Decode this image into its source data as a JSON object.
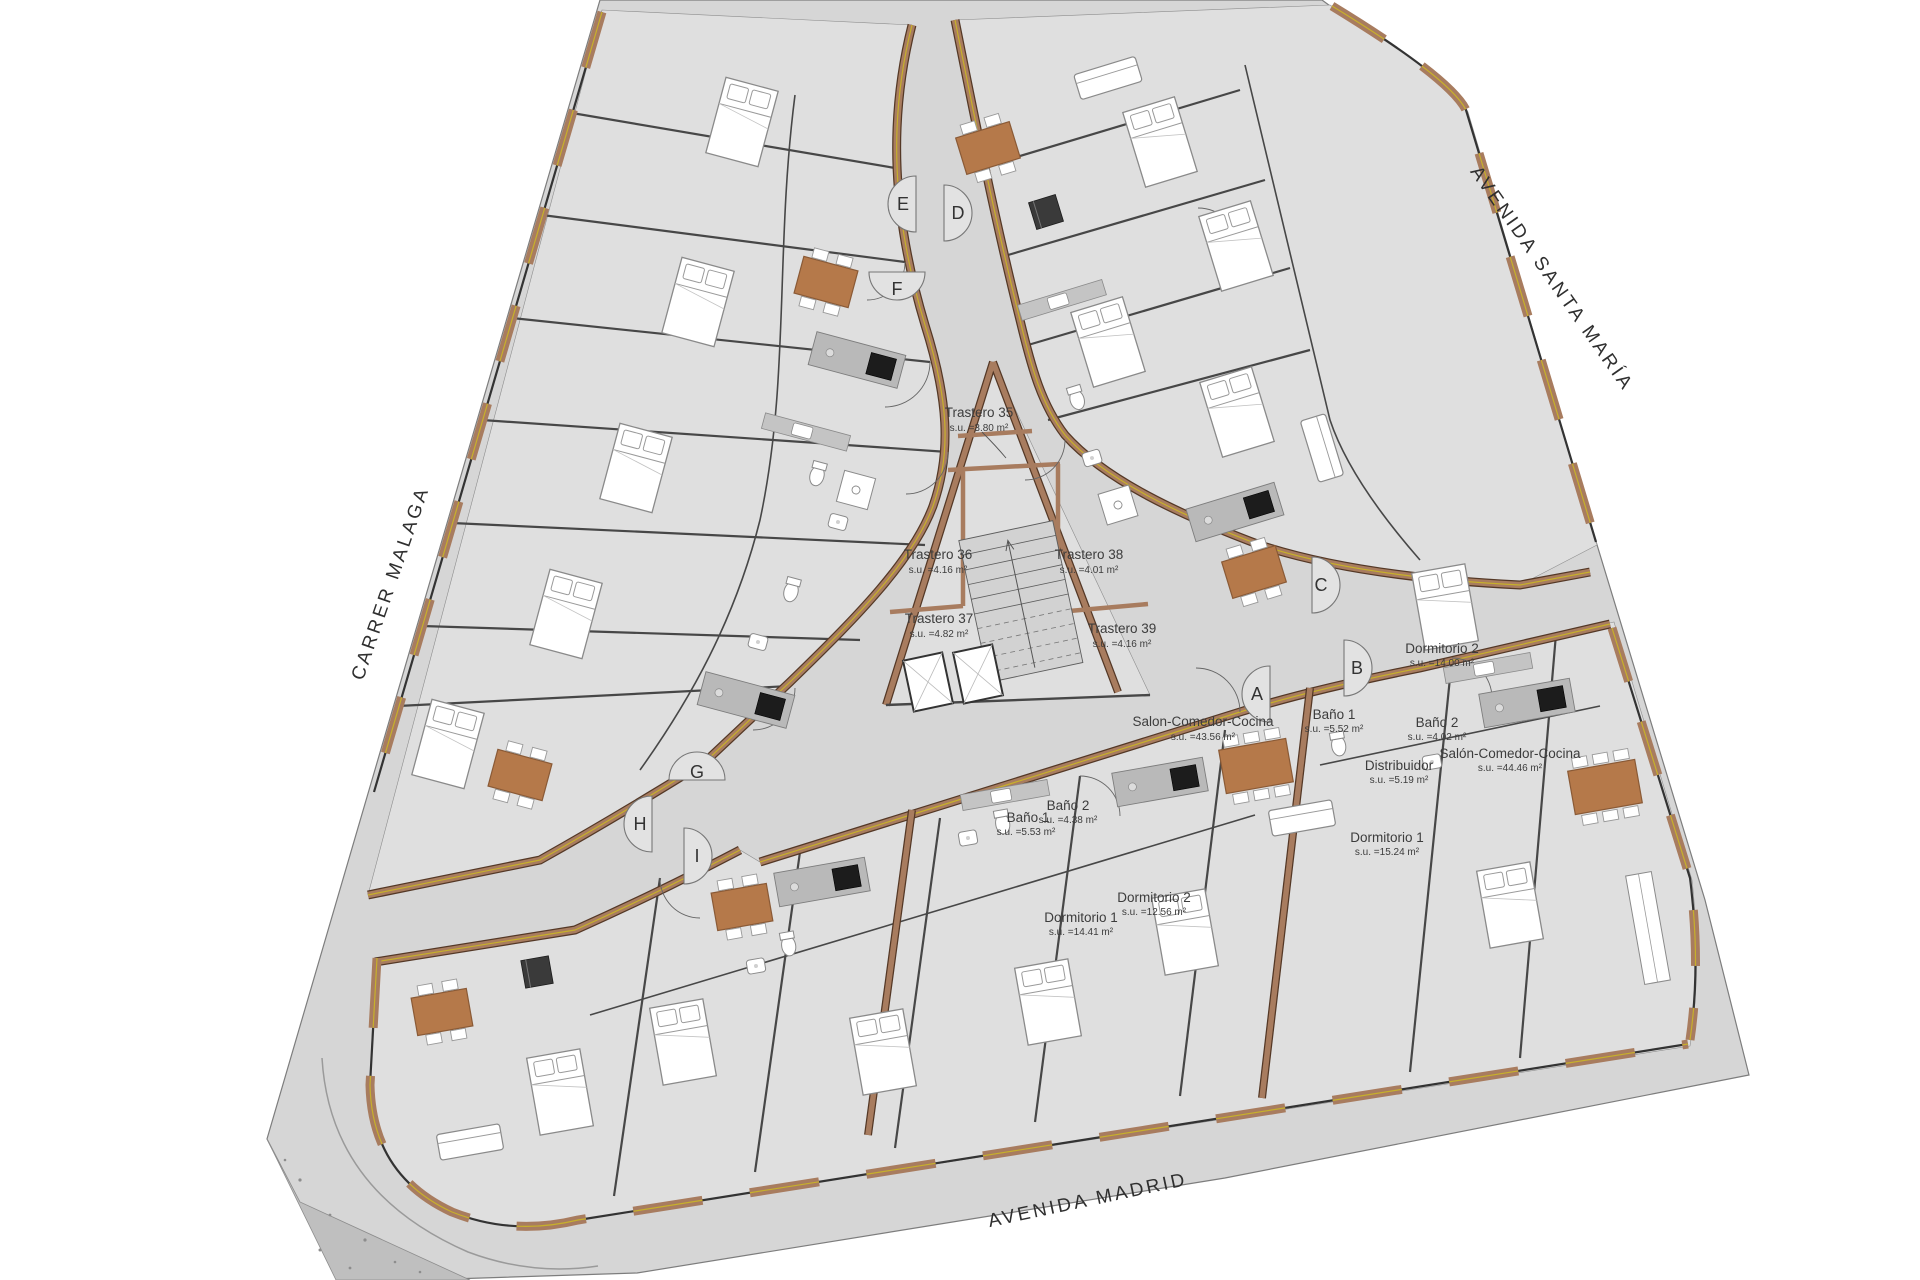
{
  "plan_title": "Triangular residential block ground floor plan",
  "streets": {
    "left": "CARRER MALAGA",
    "right": "AVENIDA SANTA MARÍA",
    "bottom": "AVENIDA MADRID"
  },
  "storage_rooms": [
    {
      "name": "Trastero 35",
      "area": "s.u. =3.80 m²"
    },
    {
      "name": "Trastero 36",
      "area": "s.u. =4.16 m²"
    },
    {
      "name": "Trastero 37",
      "area": "s.u. =4.82 m²"
    },
    {
      "name": "Trastero 38",
      "area": "s.u. =4.01 m²"
    },
    {
      "name": "Trastero 39",
      "area": "s.u. =4.16 m²"
    }
  ],
  "rooms": [
    {
      "name": "Salon-Comedor-Cocina",
      "area": "s.u. =43.56 m²"
    },
    {
      "name": "Baño 1",
      "area": "s.u. =5.52 m²"
    },
    {
      "name": "Dormitorio 2",
      "area": "s.u. =14.00 m²"
    },
    {
      "name": "Baño 2",
      "area": "s.u. =4.02 m²"
    },
    {
      "name": "Distribuidor",
      "area": "s.u. =5.19 m²"
    },
    {
      "name": "Salón-Comedor-Cocina",
      "area": "s.u. =44.46 m²"
    },
    {
      "name": "Dormitorio 1",
      "area": "s.u. =15.24 m²"
    },
    {
      "name": "Baño 1",
      "area": "s.u. =5.53 m²"
    },
    {
      "name": "Baño 2",
      "area": "s.u. =4.38 m²"
    },
    {
      "name": "Dormitorio 1",
      "area": "s.u. =14.41 m²"
    },
    {
      "name": "Dormitorio 2",
      "area": "s.u. =12.56 m²"
    }
  ],
  "entrances": [
    {
      "label": "A"
    },
    {
      "label": "B"
    },
    {
      "label": "C"
    },
    {
      "label": "D"
    },
    {
      "label": "E"
    },
    {
      "label": "F"
    },
    {
      "label": "G"
    },
    {
      "label": "H"
    },
    {
      "label": "I"
    }
  ],
  "colors": {
    "site_gray": "#d6d6d6",
    "room_gray": "#dfdfdf",
    "wall_brown": "#a87c5f",
    "wall_edge": "#543826",
    "insulation_yellow": "#c7b02b",
    "furniture_wood": "#b5794a",
    "island_gray": "#b9b9b9",
    "cooktop_black": "#1c1c1c",
    "terrain_gray": "#bfbfbf",
    "line_dark": "#3c3c3c"
  }
}
